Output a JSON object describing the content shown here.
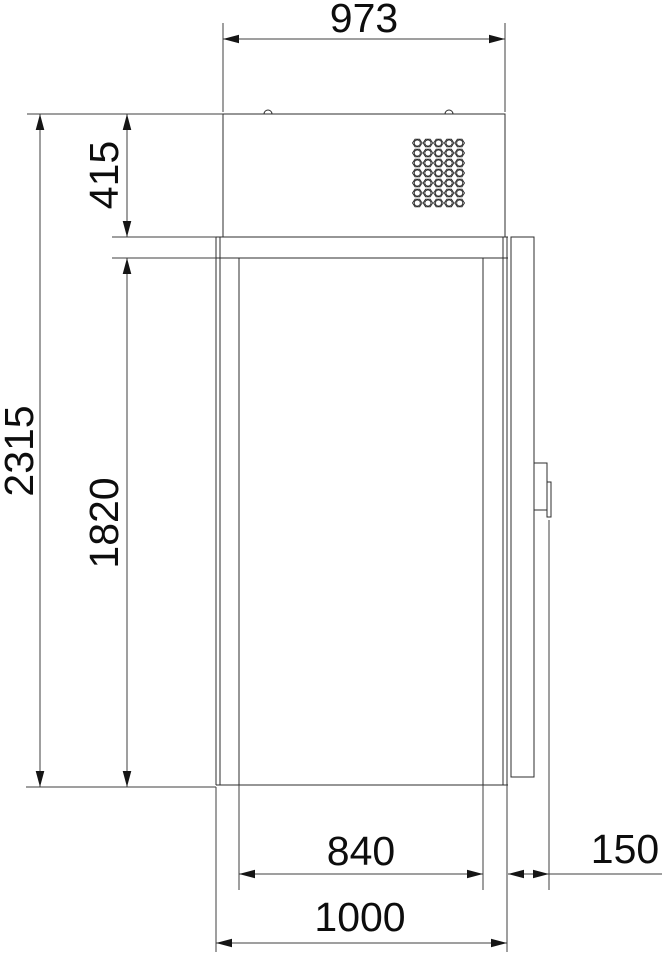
{
  "drawing": {
    "dimensions": {
      "top_width": "973",
      "overall_height": "2315",
      "condensing_unit_height": "415",
      "body_height": "1820",
      "inner_width": "840",
      "door_depth": "150",
      "overall_width": "1000"
    }
  }
}
